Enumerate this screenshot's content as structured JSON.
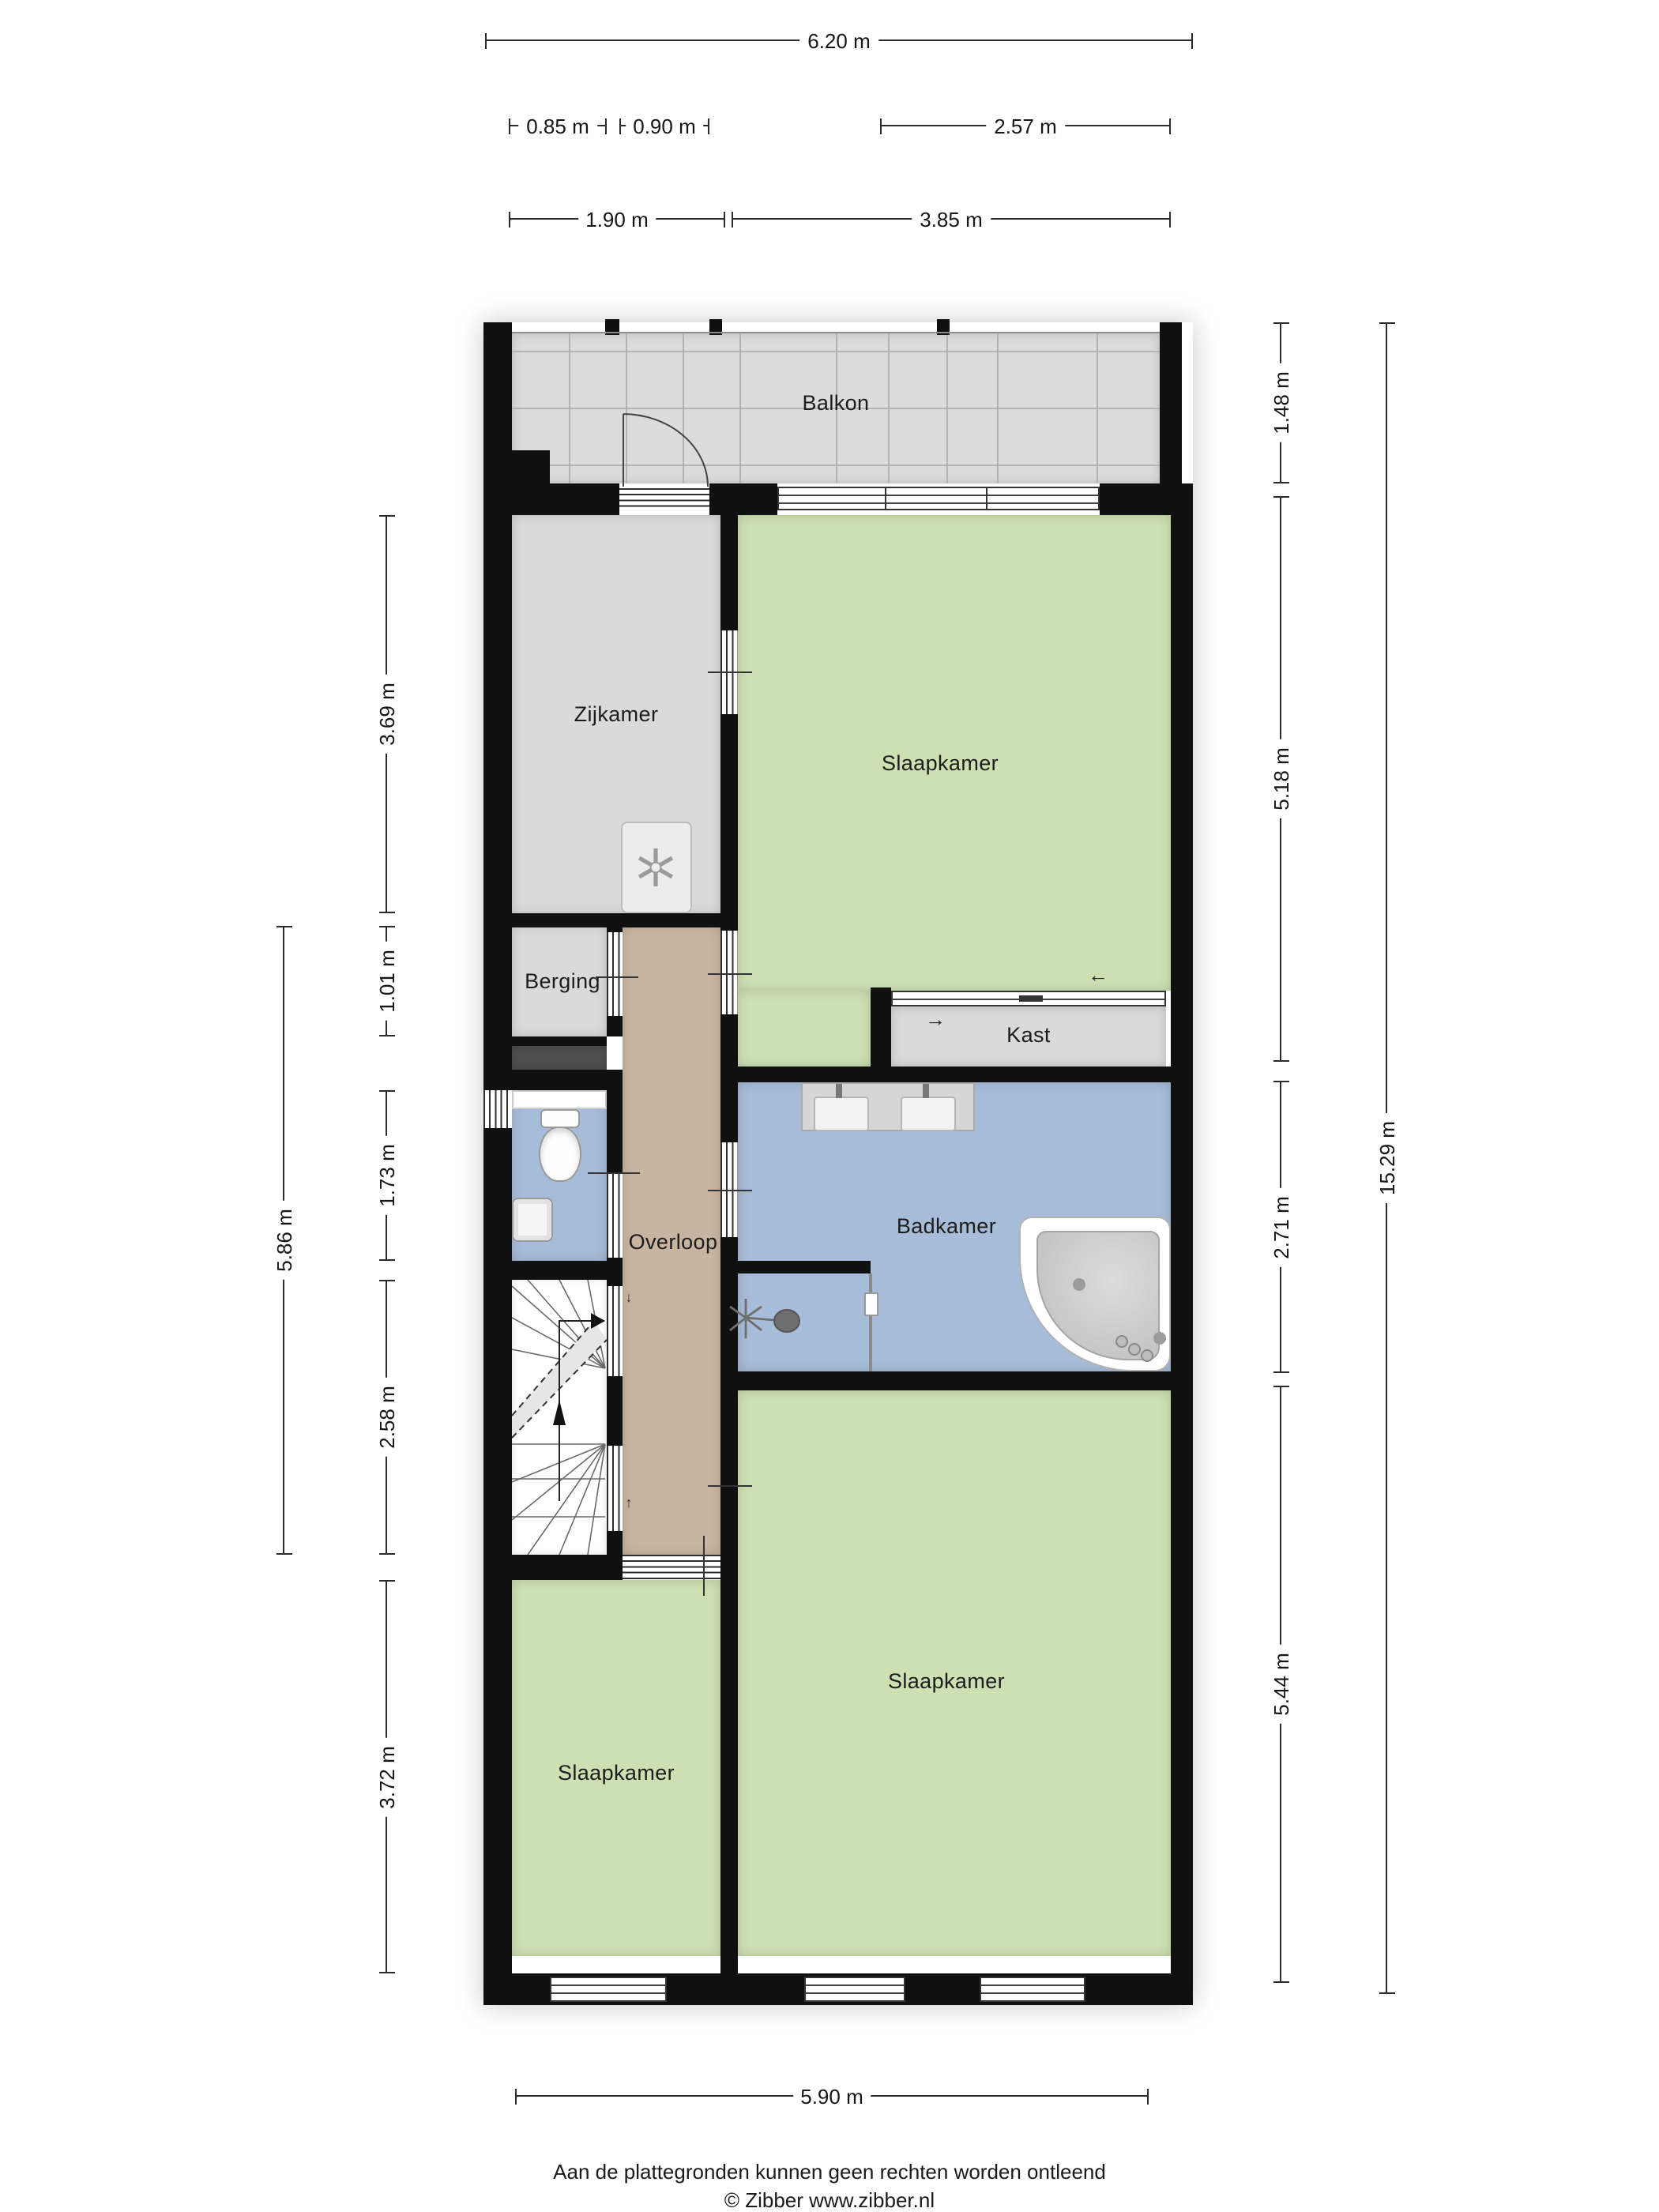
{
  "rooms": {
    "balkon": "Balkon",
    "zijkamer": "Zijkamer",
    "slaapkamer_top": "Slaapkamer",
    "berging": "Berging",
    "kast": "Kast",
    "overloop": "Overloop",
    "badkamer": "Badkamer",
    "slaapkamer_right": "Slaapkamer",
    "slaapkamer_left": "Slaapkamer"
  },
  "dimensions": {
    "width_total": "6.20 m",
    "seg_085": "0.85 m",
    "seg_090": "0.90 m",
    "seg_257": "2.57 m",
    "seg_190": "1.90 m",
    "seg_385": "3.85 m",
    "left_369": "3.69 m",
    "left_101": "1.01 m",
    "left_173": "1.73 m",
    "left_258": "2.58 m",
    "left_372": "3.72 m",
    "left_586": "5.86 m",
    "right_148": "1.48 m",
    "right_518": "5.18 m",
    "right_271": "2.71 m",
    "right_544": "5.44 m",
    "height_total": "15.29 m",
    "width_bottom": "5.90 m"
  },
  "symbols": {
    "arrow_left": "←",
    "arrow_right": "→",
    "arrow_up": "↑",
    "arrow_down": "↓"
  },
  "footer": {
    "line1": "Aan de plattegronden kunnen geen rechten worden ontleend",
    "line2": "© Zibber www.zibber.nl"
  },
  "colors": {
    "wall": "#101010",
    "floor_gray": "#dadada",
    "floor_green": "#cde0b2",
    "floor_blue": "#a7bcd8",
    "floor_tan": "#c8b5a1",
    "floor_dark": "#4f4f4f",
    "balkon_tile": "#dcdcdc"
  }
}
